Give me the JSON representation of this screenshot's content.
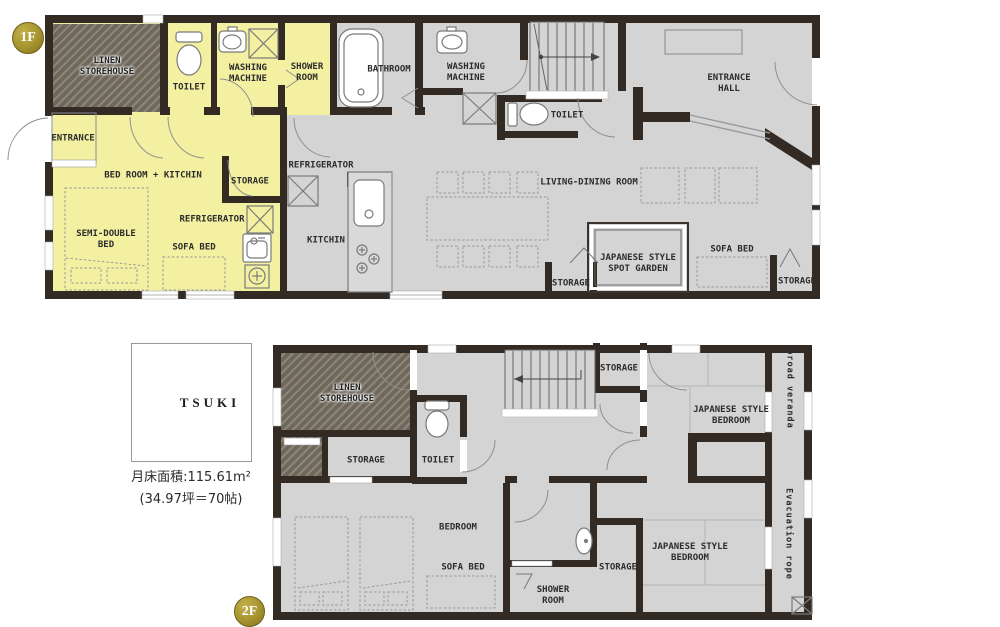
{
  "floor1": {
    "badge": "1F",
    "labels": {
      "linen_storehouse": "LINEN\nSTOREHOUSE",
      "toilet_unit": "TOILET",
      "washing_machine_unit": "WASHING\nMACHINE",
      "shower_room": "SHOWER\nROOM",
      "bathroom": "BATHROOM",
      "washing_machine": "WASHING\nMACHINE",
      "toilet": "TOILET",
      "entrance_hall": "ENTRANCE\nHALL",
      "entrance": "ENTRANCE",
      "bedroom_kitchen": "BED ROOM + KITCHIN",
      "storage_unit": "STORAGE",
      "refrigerator_unit": "REFRIGERATOR",
      "semi_double_bed": "SEMI-DOUBLE\nBED",
      "sofa_bed_unit": "SOFA BED",
      "refrigerator": "REFRIGERATOR",
      "kitchen": "KITCHIN",
      "living_dining": "LIVING-DINING ROOM",
      "spot_garden": "JAPANESE STYLE\nSPOT GARDEN",
      "sofa_bed": "SOFA BED",
      "storage_center": "STORAGE",
      "storage_right": "STORAGE"
    }
  },
  "floor2": {
    "badge": "2F",
    "labels": {
      "linen_storehouse": "LINEN\nSTOREHOUSE",
      "storage_left": "STORAGE",
      "toilet": "TOILET",
      "storage_top": "STORAGE",
      "jp_bedroom_top": "JAPANESE STYLE\nBEDROOM",
      "broad_veranda": "broad veranda",
      "bedroom": "BEDROOM",
      "sofa_bed": "SOFA BED",
      "shower_room": "SHOWER\nROOM",
      "storage_mid": "STORAGE",
      "jp_bedroom_bottom": "JAPANESE STYLE\nBEDROOM",
      "evacuation_rope": "Evacuation rope"
    }
  },
  "logo": {
    "kanji": "月",
    "name": "TSUKI",
    "area_line1": "月床面積:115.61m²",
    "area_line2": "(34.97坪＝70帖)"
  },
  "colors": {
    "unit_yellow": "#f4f0a2",
    "floor_gray": "#d4d4d4",
    "wall_dark": "#332a24",
    "hatch_gray": "#6e675c",
    "badge_gold": "#a5932f"
  }
}
